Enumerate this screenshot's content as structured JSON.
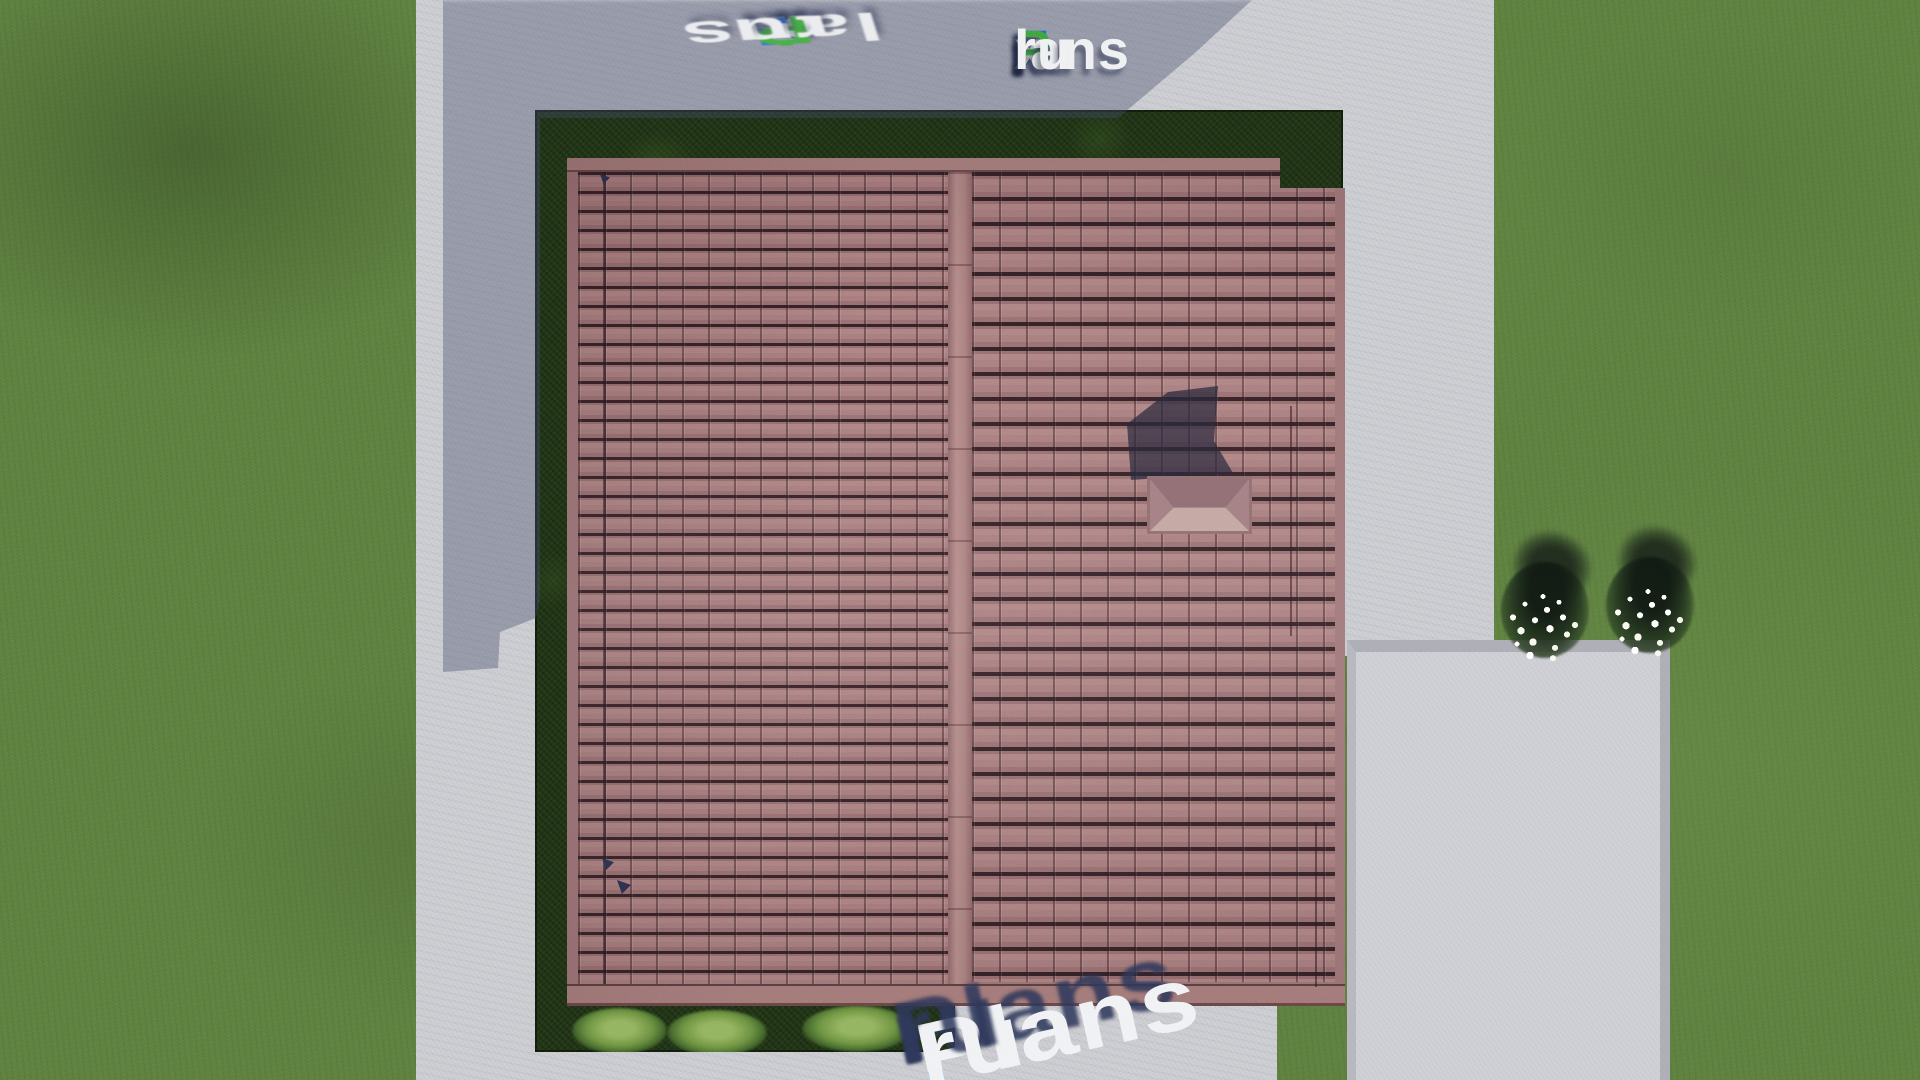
{
  "logo": {
    "text": "FixPlans.ru",
    "parts": [
      {
        "text": "F",
        "color": "#1b66cd"
      },
      {
        "text": "i",
        "color": "#3da23c"
      },
      {
        "text": "x",
        "color": "#e9ebee"
      },
      {
        "text": "P",
        "color": "#3da23c"
      },
      {
        "text": "lans",
        "color": "#eef0f2"
      },
      {
        "text": ".",
        "color": "#2a86e8"
      },
      {
        "text": "ru",
        "color": "#eef0f2"
      }
    ]
  },
  "watermark_top": {
    "text": "FixPlans.ru",
    "parts": [
      {
        "text": "F",
        "color": "#2a6fd8"
      },
      {
        "text": "i",
        "color": "#3fae3c"
      },
      {
        "text": "x",
        "color": "#f2f3f5"
      },
      {
        "text": "P",
        "color": "#3fae3c"
      },
      {
        "text": "lans",
        "color": "#f2f3f5"
      },
      {
        "text": ".",
        "color": "#2a6fd8"
      },
      {
        "text": "ru",
        "color": "#f2f3f5"
      }
    ]
  },
  "watermark_bottom": {
    "text": "Plans.ru",
    "parts": [
      {
        "text": "Plans",
        "color": "#eff1f4"
      },
      {
        "text": ".",
        "color": "#2e8fe8"
      },
      {
        "text": "ru",
        "color": "#eff1f4"
      }
    ]
  },
  "palette": {
    "grass": "#5b7c3e",
    "grass_shadow": "#46622f",
    "concrete": "#c9cacf",
    "concrete_shadow": "#8e93a8",
    "patio": "#cbccd2",
    "curb": "#a9aab2",
    "hedge": "#203216",
    "garden_bush": "#7da24f",
    "roof_tile": "#a5797a",
    "roof_tile_gap": "#332126",
    "roof_trim": "#a87e7c",
    "chimney_shadow": "#26263a",
    "skylight_top": "#8a686d",
    "skylight_bottom": "#c0a39d",
    "flower": "#ffffff",
    "logo_blue": "#1b66cd",
    "logo_green": "#3da23c",
    "logo_white": "#eef0f2",
    "watermark_shadow": "#2c3854"
  }
}
